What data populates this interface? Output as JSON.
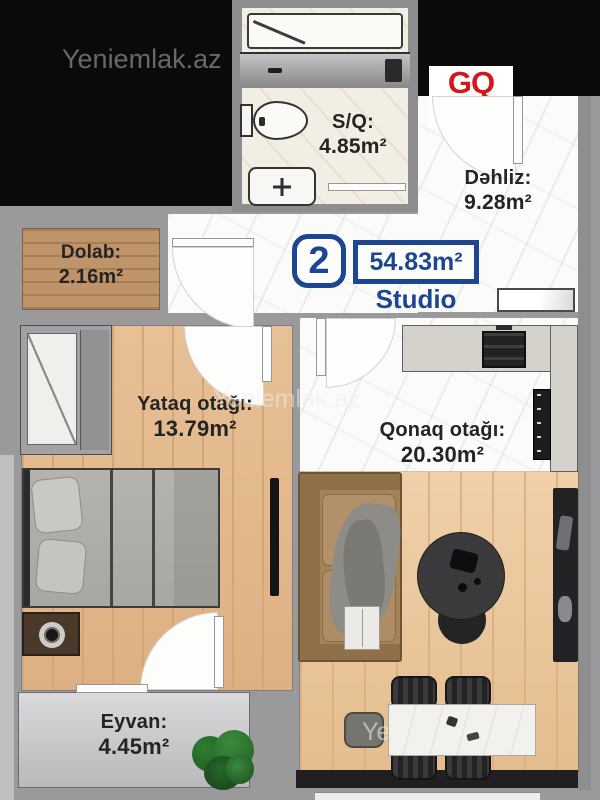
{
  "brand": {
    "watermark_top": "Yeniemlak.az",
    "watermark_middle": "Yeniemlak.az",
    "watermark_bottom": "Yeniemlak.az",
    "builder_logo": "GQ"
  },
  "badge": {
    "apartment_number": "2",
    "total_area": "54.83m²",
    "apartment_type": "Studio"
  },
  "rooms": {
    "bathroom": {
      "label": "S/Q:",
      "area": "4.85m²"
    },
    "hallway": {
      "label": "Dəhliz:",
      "area": "9.28m²"
    },
    "closet": {
      "label": "Dolab:",
      "area": "2.16m²"
    },
    "bedroom": {
      "label": "Yataq otağı:",
      "area": "13.79m²"
    },
    "living_room": {
      "label": "Qonaq otağı:",
      "area": "20.30m²"
    },
    "balcony": {
      "label": "Eyvan:",
      "area": "4.45m²"
    }
  },
  "colors": {
    "logo_red": "#d6151c",
    "badge_blue": "#1d4690"
  }
}
